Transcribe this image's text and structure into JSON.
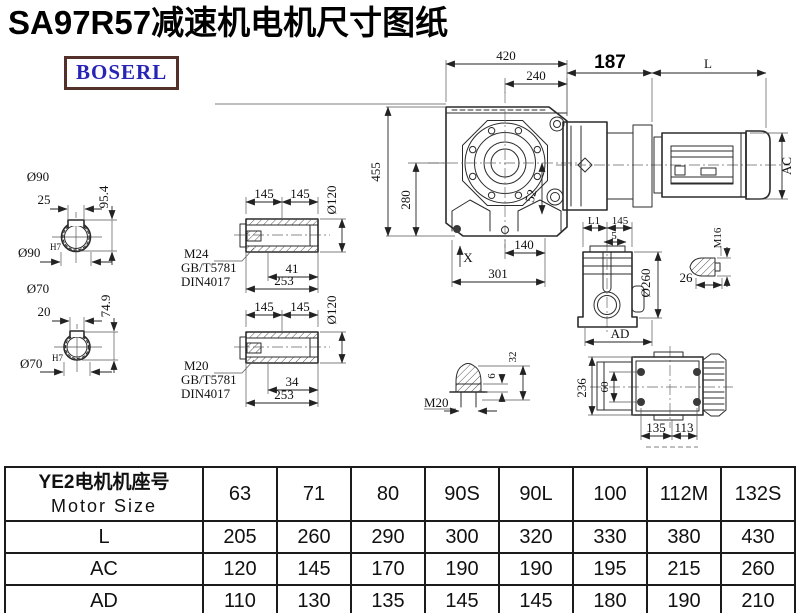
{
  "page": {
    "title": "SA97R57减速机电机尺寸图纸"
  },
  "logo": {
    "text": "BOSERL",
    "text_color": "#2824b4",
    "border_color": "#53302a"
  },
  "drawing": {
    "front_view": {
      "top_width": "420",
      "flange_width": "240",
      "height": "455",
      "center_height": "280",
      "offset": "52",
      "bottom_center": "140",
      "bottom_width": "301",
      "axis": "X"
    },
    "motor_view": {
      "flange_len": "187",
      "motor_len": "L",
      "motor_dia": "AC"
    },
    "shaft_90": {
      "dia": "Ø90",
      "key_width": "25",
      "key_height": "95.4",
      "fit_dia": "Ø90",
      "fit_tol": "H7"
    },
    "shaft_70": {
      "dia": "Ø70",
      "key_width": "20",
      "key_height": "74.9",
      "fit_dia": "Ø70",
      "fit_tol": "H7"
    },
    "bushing_m24": {
      "len_a": "145",
      "len_b": "145",
      "dia": "Ø120",
      "thread": "M24",
      "std_gb": "GB/T5781",
      "std_din": "DIN4017",
      "depth": "41",
      "total_len": "253"
    },
    "bushing_m20": {
      "len_a": "145",
      "len_b": "145",
      "dia": "Ø120",
      "thread": "M20",
      "std_gb": "GB/T5781",
      "std_din": "DIN4017",
      "depth": "34",
      "total_len": "253"
    },
    "side_view": {
      "len_l1": "L1",
      "len_145": "145",
      "len_5": "5",
      "dia": "Ø260",
      "width_ad": "AD"
    },
    "bolt_m16": {
      "thread": "M16",
      "len": "26"
    },
    "bolt_m20": {
      "thread": "M20",
      "tip": "6",
      "len": "32"
    },
    "bottom_view": {
      "height": "236",
      "hole_span": "60",
      "left": "135",
      "right": "113"
    }
  },
  "table": {
    "header": {
      "label_cn": "YE2电机机座号",
      "label_en": "Motor Size",
      "sizes": [
        "63",
        "71",
        "80",
        "90S",
        "90L",
        "100",
        "112M",
        "132S"
      ]
    },
    "rows": [
      {
        "label": "L",
        "values": [
          "205",
          "260",
          "290",
          "300",
          "320",
          "330",
          "380",
          "430"
        ]
      },
      {
        "label": "AC",
        "values": [
          "120",
          "145",
          "170",
          "190",
          "190",
          "195",
          "215",
          "260"
        ]
      },
      {
        "label": "AD",
        "values": [
          "110",
          "130",
          "135",
          "145",
          "145",
          "180",
          "190",
          "210"
        ]
      }
    ]
  }
}
